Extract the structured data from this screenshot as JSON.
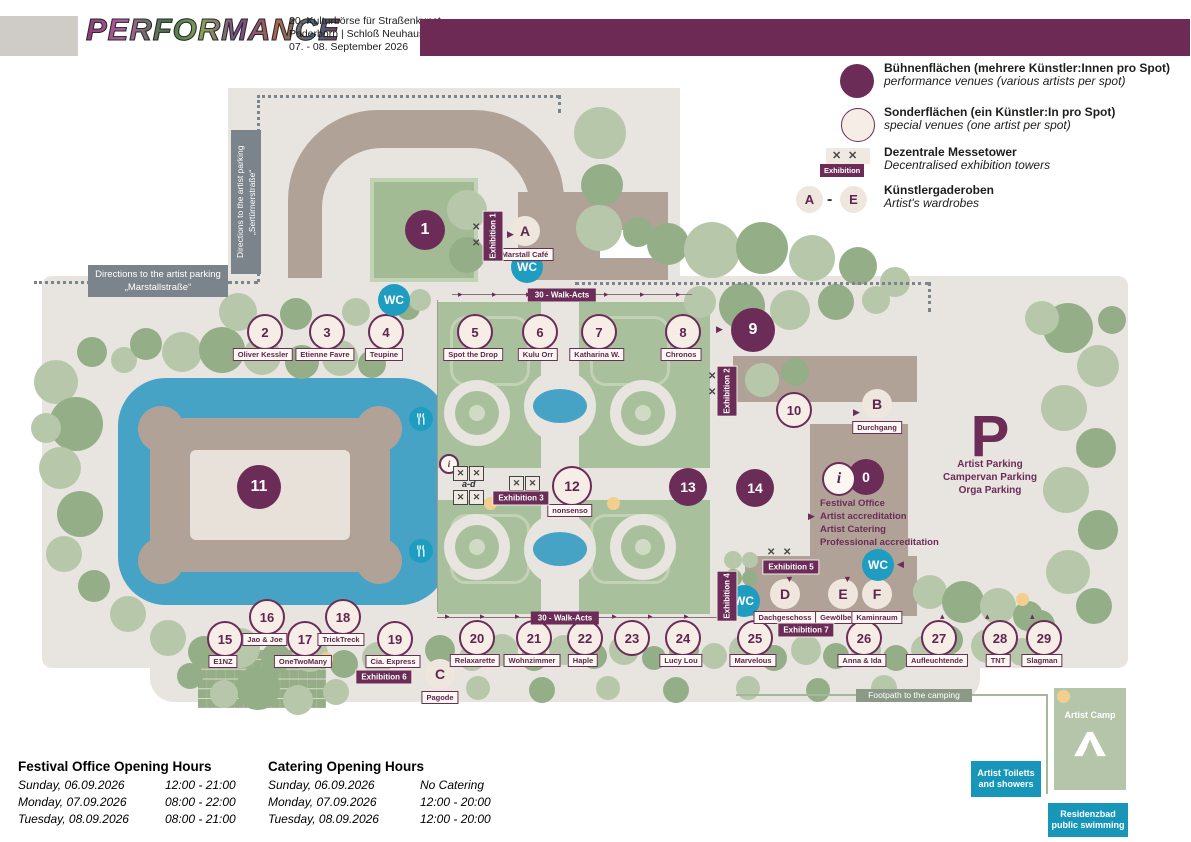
{
  "header": {
    "logo": "PERFORMANCE",
    "line1": "20. Kulturbörse für Straßenkunst",
    "line2": "Paderborn | Schloß Neuhaus",
    "line3": "07. - 08. September 2026"
  },
  "legend": {
    "items": [
      {
        "kind": "performance",
        "title": "Bühnenflächen (mehrere Künstler:Innen pro Spot)",
        "subtitle": "performance venues (various artists per spot)"
      },
      {
        "kind": "special",
        "title": "Sonderflächen (ein Künstler:In pro Spot)",
        "subtitle": "special venues (one artist per spot)"
      },
      {
        "kind": "exhibition",
        "badge": "Exhibition",
        "title": "Dezentrale Messetower",
        "subtitle": "Decentralised exhibition towers"
      },
      {
        "kind": "wardrobe",
        "from": "A",
        "to": "E",
        "title": "Künstlergaderoben",
        "subtitle": "Artist's wardrobes"
      }
    ]
  },
  "venues": [
    {
      "number": "1",
      "kind": "performance"
    },
    {
      "number": "2",
      "kind": "special",
      "name": "Oliver Kessler"
    },
    {
      "number": "3",
      "kind": "special",
      "name": "Etienne Favre"
    },
    {
      "number": "4",
      "kind": "special",
      "name": "Teupine"
    },
    {
      "number": "5",
      "kind": "special",
      "name": "Spot the Drop"
    },
    {
      "number": "6",
      "kind": "special",
      "name": "Kulu Orr"
    },
    {
      "number": "7",
      "kind": "special",
      "name": "Katharina W."
    },
    {
      "number": "8",
      "kind": "special",
      "name": "Chronos"
    },
    {
      "number": "9",
      "kind": "performance"
    },
    {
      "number": "10",
      "kind": "special"
    },
    {
      "number": "11",
      "kind": "performance"
    },
    {
      "number": "12",
      "kind": "special",
      "name": "nonsenso"
    },
    {
      "number": "13",
      "kind": "performance"
    },
    {
      "number": "14",
      "kind": "performance"
    },
    {
      "number": "15",
      "kind": "special",
      "name": "E1NZ"
    },
    {
      "number": "16",
      "kind": "special",
      "name": "Jao & Joe"
    },
    {
      "number": "17",
      "kind": "special",
      "name": "OneTwoMany"
    },
    {
      "number": "18",
      "kind": "special",
      "name": "TrickTreck"
    },
    {
      "number": "19",
      "kind": "special",
      "name": "Cia. Express"
    },
    {
      "number": "20",
      "kind": "special",
      "name": "Relaxarette"
    },
    {
      "number": "21",
      "kind": "special",
      "name": "Wohnzimmer"
    },
    {
      "number": "22",
      "kind": "special",
      "name": "Haple"
    },
    {
      "number": "23",
      "kind": "special"
    },
    {
      "number": "24",
      "kind": "special",
      "name": "Lucy Lou"
    },
    {
      "number": "25",
      "kind": "special",
      "name": "Marvelous"
    },
    {
      "number": "26",
      "kind": "special",
      "name": "Anna & Ida"
    },
    {
      "number": "27",
      "kind": "special",
      "name": "Aufleuchtende"
    },
    {
      "number": "28",
      "kind": "special",
      "name": "TNT"
    },
    {
      "number": "29",
      "kind": "special",
      "name": "Slagman"
    },
    {
      "number": "0",
      "kind": "performance"
    }
  ],
  "wardrobes": [
    {
      "letter": "A",
      "name": "Marstall Café"
    },
    {
      "letter": "B",
      "name": "Durchgang"
    },
    {
      "letter": "C",
      "name": "Pagode"
    },
    {
      "letter": "D",
      "name": "Dachgeschoss"
    },
    {
      "letter": "E",
      "name": "Gewölbesaal"
    },
    {
      "letter": "F",
      "name": "Kaminraum"
    }
  ],
  "info_circle": {
    "letter": "i"
  },
  "wc_label": "WC",
  "exhibitions": [
    "Exhibition 1",
    "Exhibition 2",
    "Exhibition 3",
    "Exhibition 4",
    "Exhibition 5",
    "Exhibition 6",
    "Exhibition 7"
  ],
  "walk_acts_label": "30 - Walk-Acts",
  "tower_group_label": "a-d",
  "directions": {
    "vertical": "Directions to the artist parking „Sertürnerstraße“",
    "horizontal_l1": "Directions to the artist parking",
    "horizontal_l2": "„Marstallstraße“"
  },
  "parking": {
    "symbol": "P",
    "lines": [
      "Artist Parking",
      "Campervan Parking",
      "Orga Parking"
    ]
  },
  "festival_office_lines": [
    "Festival Office",
    "Artist accreditation",
    "Artist Catering",
    "Professional accreditation"
  ],
  "camp": {
    "title": "Artist Camp",
    "toilets": "Artist Toiletts and showers",
    "swimming": "Residenzbad public swimming",
    "footpath": "Footpath to the camping"
  },
  "hours": {
    "office": {
      "title": "Festival Office Opening Hours",
      "rows": [
        {
          "day": "Sunday, 06.09.2026",
          "time": "12:00 - 21:00"
        },
        {
          "day": "Monday, 07.09.2026",
          "time": "08:00 - 22:00"
        },
        {
          "day": "Tuesday, 08.09.2026",
          "time": "08:00 - 21:00"
        }
      ]
    },
    "catering": {
      "title": "Catering Opening Hours",
      "rows": [
        {
          "day": "Sunday, 06.09.2026",
          "time": "No Catering"
        },
        {
          "day": "Monday, 07.09.2026",
          "time": "12:00 - 20:00"
        },
        {
          "day": "Tuesday, 08.09.2026",
          "time": "12:00 - 20:00"
        }
      ]
    }
  },
  "colors": {
    "accent": "#6b2c57",
    "wc_teal": "#1f9dc0",
    "lake_blue": "#47a3c6",
    "building": "#b1a298",
    "map_bg": "#e8e4df",
    "tree_light": "#b7c8aa",
    "tree_dark": "#94af87",
    "label_gray": "#7b848b",
    "badge_teal": "#1796ba"
  }
}
